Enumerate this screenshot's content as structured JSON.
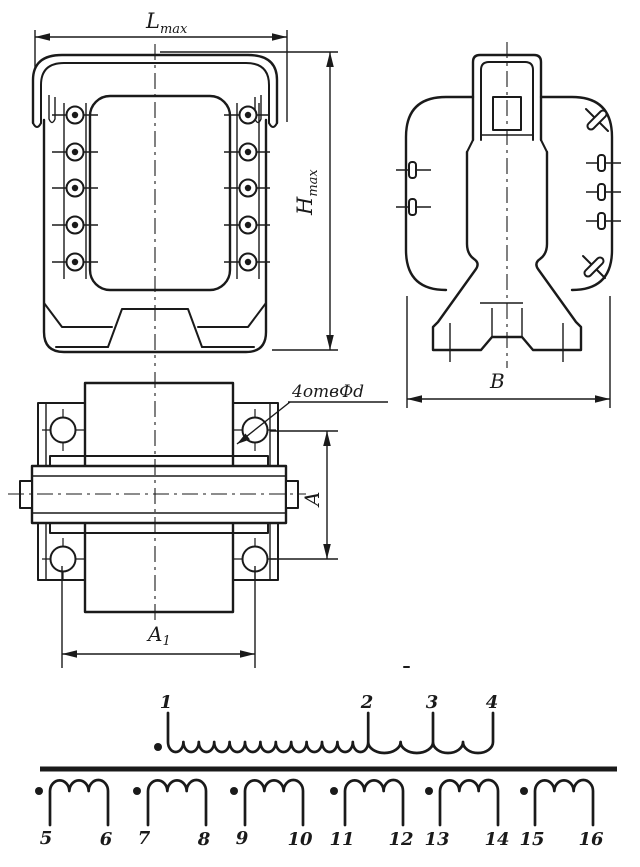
{
  "labels": {
    "length": {
      "main": "L",
      "sub": "max"
    },
    "height": {
      "main": "H",
      "sub": "max"
    },
    "width": "В",
    "hole_pitch_vertical": "A",
    "hole_pitch_horizontal": {
      "main": "A",
      "sub": "1"
    },
    "holes_note": "4отвФd"
  },
  "schematic": {
    "primary": {
      "terminals": [
        "1",
        "2",
        "3",
        "4"
      ],
      "loop_groups": [
        13,
        2,
        2
      ],
      "phase_dot": true
    },
    "secondaries": [
      {
        "start": "5",
        "end": "6",
        "loops": 3
      },
      {
        "start": "7",
        "end": "8",
        "loops": 3
      },
      {
        "start": "9",
        "end": "10",
        "loops": 3
      },
      {
        "start": "11",
        "end": "12",
        "loops": 3
      },
      {
        "start": "13",
        "end": "14",
        "loops": 3
      },
      {
        "start": "15",
        "end": "16",
        "loops": 3
      }
    ]
  },
  "colors": {
    "ink": "#1a1a1a",
    "paper": "#ffffff"
  }
}
